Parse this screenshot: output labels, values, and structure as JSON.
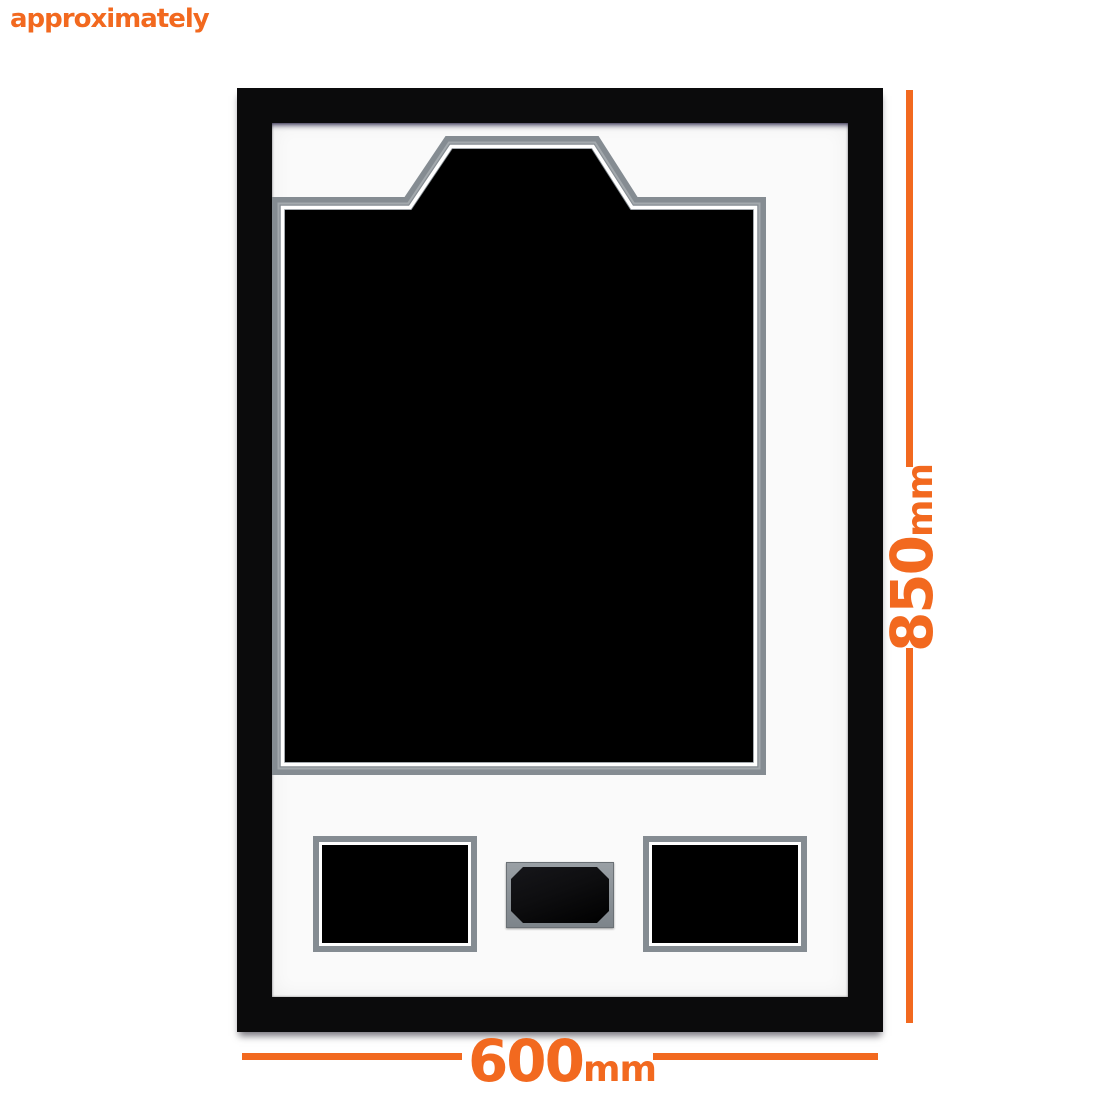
{
  "annotations": {
    "approx_label": "approximately",
    "height_dimension": {
      "value": "850",
      "unit": "mm"
    },
    "width_dimension": {
      "value": "600",
      "unit": "mm"
    },
    "accent_color": "#F2691F"
  },
  "frame": {
    "frame_color": "#0B0B0C",
    "mat_color": "#FAFAFA",
    "trim_color": "#858C92",
    "plaque_color": "#0E0E10"
  }
}
